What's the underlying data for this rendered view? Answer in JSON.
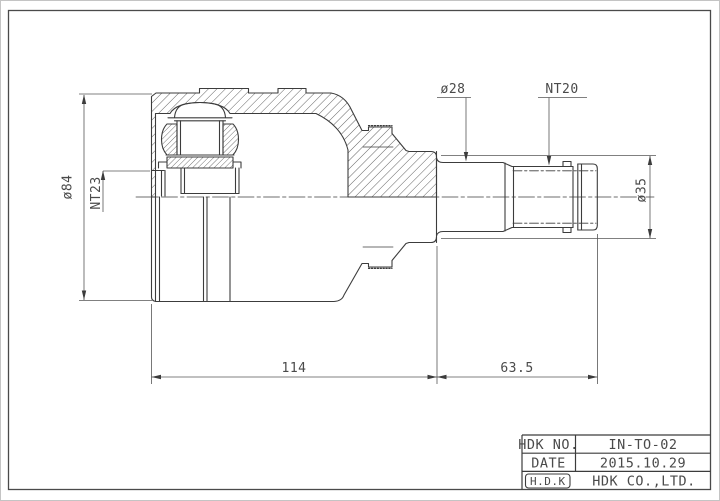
{
  "title_block": {
    "rows": [
      {
        "label": "HDK NO.",
        "value": "IN-TO-02"
      },
      {
        "label": "DATE",
        "value": "2015.10.29"
      },
      {
        "label": "H.D.K",
        "value": "HDK CO.,LTD."
      }
    ]
  },
  "dimensions": {
    "housing_od": "ø84",
    "inner_spline": "NT23",
    "shaft_dia": "ø28",
    "stem_spline": "NT20",
    "collar_dia": "ø35",
    "body_length": "114",
    "stem_length": "63.5"
  },
  "colors": {
    "paper": "#ffffff",
    "line": "#3c3c3c",
    "dim_line": "#565656",
    "text": "#4a4a4a",
    "frame": "#4a4a4a"
  }
}
